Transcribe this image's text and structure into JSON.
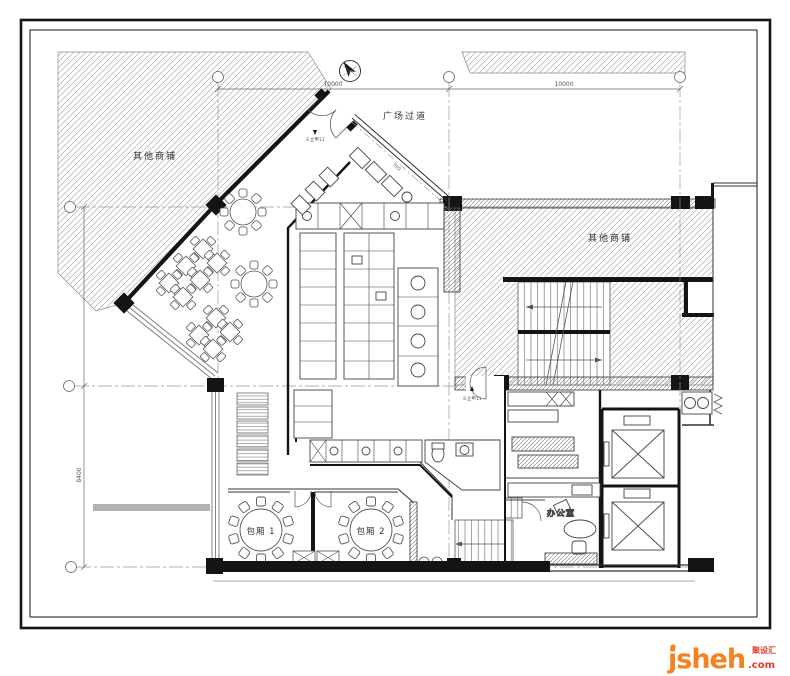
{
  "colors": {
    "paper": "#ffffff",
    "line_dark": "#141414",
    "line_mid": "#444444",
    "hatch": "#9a9a9a",
    "watermark_orange": "#F58220",
    "watermark_red": "#E73828"
  },
  "drawing": {
    "labels": {
      "shop_left": "其他商铺",
      "shop_right": "其他商铺",
      "plaza": "广场过道",
      "room1": "包厢 1",
      "room2": "包厢 2",
      "office": "办公室",
      "elev_marker_top": "义立甲11",
      "elev_marker_mid": "义立甲11"
    },
    "dimensions": {
      "top_span_left": "10000",
      "top_span_right": "10000",
      "left_span": "8400",
      "entry_diag": "500"
    }
  },
  "watermark": {
    "brand": "jsheh",
    "tld": ".com",
    "cn_tag": "聚设汇"
  }
}
